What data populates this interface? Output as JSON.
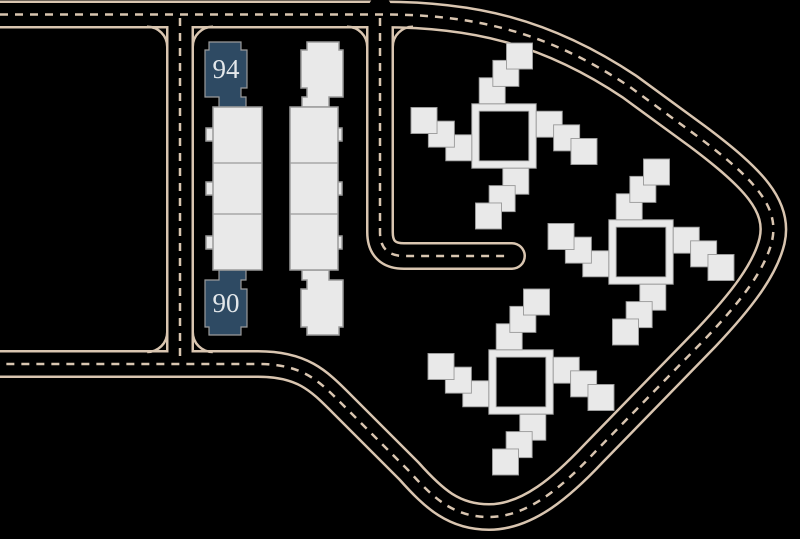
{
  "site_plan": {
    "background": "#000000",
    "roads": {
      "line_color": "#d9c5b0"
    },
    "buildings": {
      "fill": "#e9e9e9",
      "outline": "#9b9b9b",
      "highlight_fill": "#2e4a63",
      "highlight_label_color": "#e3e7ea",
      "highlighted": [
        {
          "label": "94"
        },
        {
          "label": "90"
        }
      ]
    }
  }
}
